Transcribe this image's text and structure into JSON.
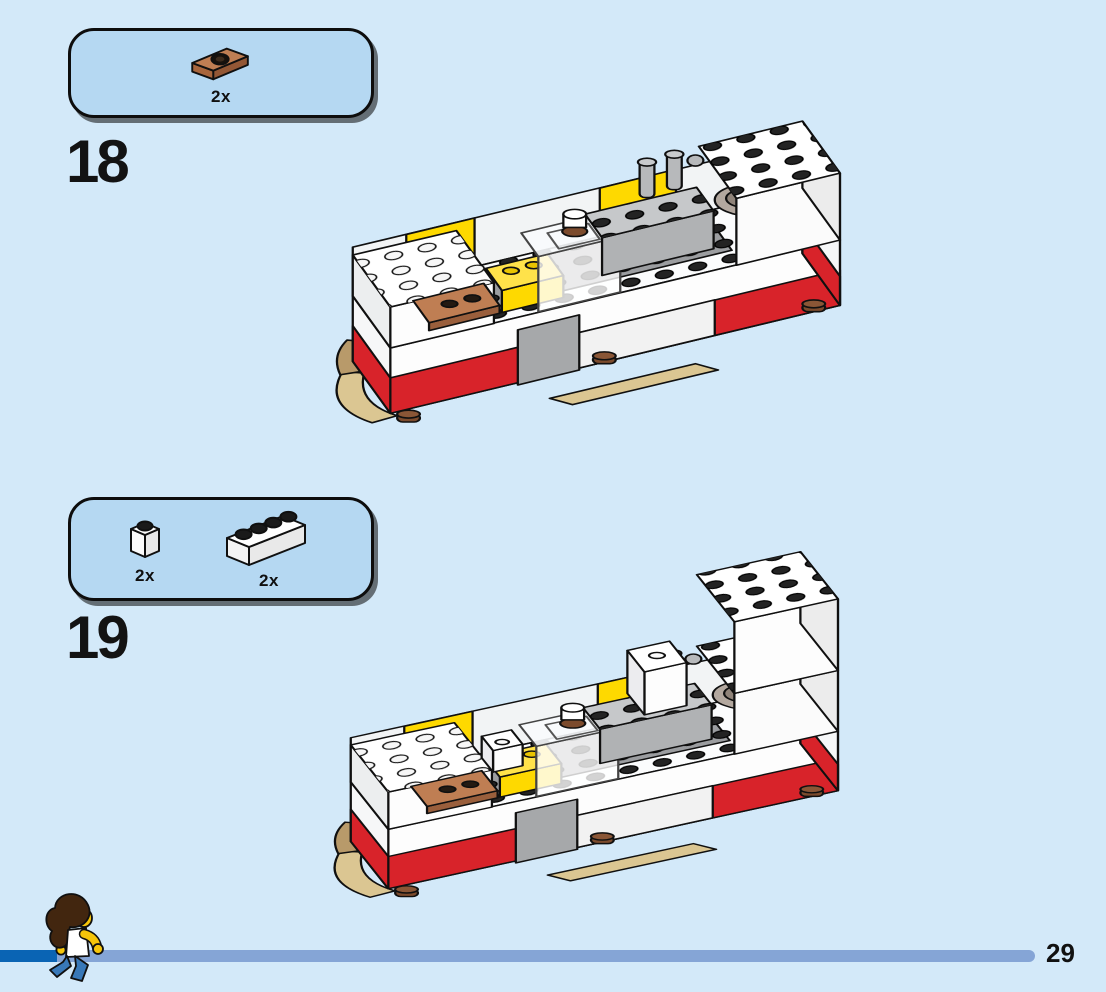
{
  "page": {
    "background_color": "#d3e9f9",
    "type": "lego-building-instructions"
  },
  "steps": [
    {
      "number": "18",
      "parts_box": {
        "parts": [
          {
            "name": "plate-1x2-with-1-stud-medium-nougat",
            "quantity": "2x",
            "color": "#bf7e53"
          }
        ]
      },
      "model": {
        "description": "Isometric view of partially built white and red camper chassis: white deck with dark studs, red stripe sides, yellow brick accents, gray kitchen counter with faucet posts and sink bowl, translucent unit, medium nougat jumper plates on left deck, tan skids and reddish brown feet underneath."
      }
    },
    {
      "number": "19",
      "parts_box": {
        "parts": [
          {
            "name": "brick-1x1-white",
            "quantity": "2x",
            "color": "#ffffff"
          },
          {
            "name": "brick-1x4-white",
            "quantity": "2x",
            "color": "#ffffff"
          }
        ]
      },
      "model": {
        "description": "Same camper chassis after adding two white 1x1 bricks standing on the deck and white 1x4 bricks stacked into a tall wall at the rear right corner."
      }
    }
  ],
  "footer": {
    "page_number": "29",
    "progress_bar": {
      "track_color": "#85a5d6",
      "fill_color": "#0a64b4"
    },
    "minifigure": "curly-haired minifigure walking right, white top, yellow arms, blue jeans"
  },
  "accent_colors": {
    "callout_background": "#b5d8f2",
    "callout_border": "#0d0d0d",
    "lego_red": "#d8232a",
    "lego_yellow": "#fed900",
    "medium_nougat": "#bf7e53",
    "tan": "#dbc692",
    "gray": "#b0b2b4"
  }
}
